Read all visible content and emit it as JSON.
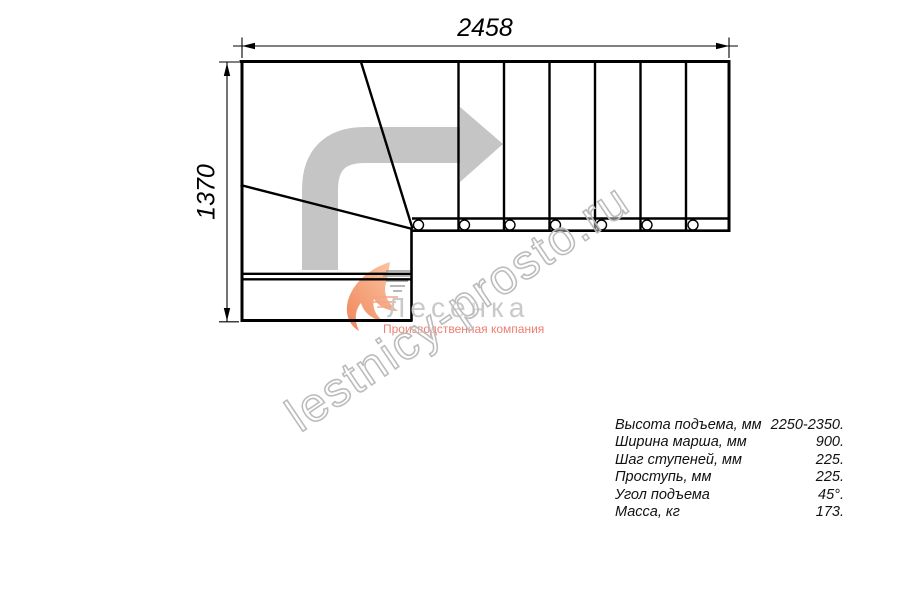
{
  "drawing": {
    "width_label": "2458",
    "height_label": "1370"
  },
  "logo": {
    "name": "Лесенка",
    "tagline": "Производственная компания"
  },
  "watermark": {
    "text": "lestnicy-prosto.ru"
  },
  "specs": {
    "rows": [
      {
        "label": "Высота подъема, мм",
        "value": "2250-2350."
      },
      {
        "label": "Ширина марша, мм",
        "value": "900."
      },
      {
        "label": "Шаг ступеней, мм",
        "value": "225."
      },
      {
        "label": "Проступь, мм",
        "value": "225."
      },
      {
        "label": "Угол подъема",
        "value": "45°."
      },
      {
        "label": "Масса, кг",
        "value": "173."
      }
    ]
  },
  "colors": {
    "line": "#000000",
    "direction_arrow_gray": "#c5c5c5",
    "watermark_gray": "#bcbcbc",
    "logo_text_gray": "#c9c9c9",
    "logo_accent_salmon": "#ee7e72",
    "logo_swoosh_orange": "#f29b6f"
  }
}
